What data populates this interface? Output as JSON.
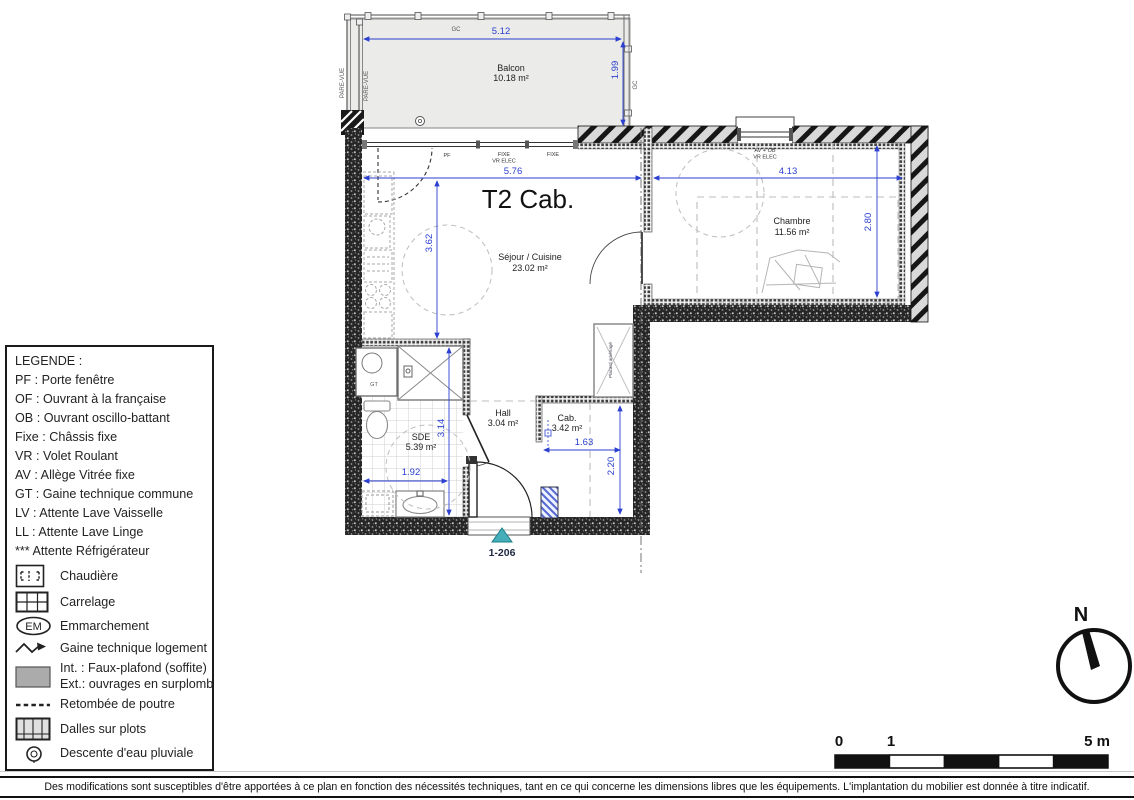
{
  "title": "T2 Cab.",
  "plan": {
    "balcony": {
      "name": "Balcon",
      "area": "10.18 m²",
      "width": "5.12",
      "depth": "1.99",
      "gc_top": "GC",
      "gc_right": "GC",
      "pare_vue_1": "PARE-VUE",
      "pare_vue_2": "PARE-VUE"
    },
    "sejour": {
      "name": "Séjour / Cuisine",
      "area": "23.02 m²",
      "width": "5.76",
      "height": "3.62"
    },
    "chambre": {
      "name": "Chambre",
      "area": "11.56 m²",
      "width": "4.13",
      "height": "2.80"
    },
    "sde": {
      "name": "SDE",
      "area": "5.39 m²",
      "width": "1.92",
      "height": "3.14"
    },
    "hall": {
      "name": "Hall",
      "area": "3.04 m²"
    },
    "cab": {
      "name": "Cab.",
      "area": "3.42 m²",
      "width": "1.63",
      "height": "2.20"
    },
    "placard": {
      "name": "Placard aménagé"
    },
    "gt_label": "GT",
    "entry_ref": "1-206",
    "window_labels": {
      "pf": "PF",
      "fixe": "FIXE",
      "vr_elec": "VR ELEC",
      "fixe2": "FIXE",
      "av_ob": "AV + OB",
      "vr_elec2": "VR ELEC"
    }
  },
  "legend": {
    "title": "LEGENDE :",
    "lines": [
      "PF : Porte fenêtre",
      "OF : Ouvrant à la française",
      "OB : Ouvrant oscillo-battant",
      "Fixe : Châssis fixe",
      "VR : Volet Roulant",
      "AV : Allège Vitrée fixe",
      "GT : Gaine technique commune",
      "LV : Attente Lave Vaisselle",
      "LL : Attente Lave Linge",
      "*** Attente Réfrigérateur"
    ],
    "icon_items": [
      {
        "icon": "boiler-icon",
        "text": "Chaudière"
      },
      {
        "icon": "tiles-icon",
        "text": "Carrelage"
      },
      {
        "icon": "em-icon",
        "em": "EM",
        "text": "Emmarchement"
      },
      {
        "icon": "duct-arrow-icon",
        "text": "Gaine technique logement"
      },
      {
        "icon": "soffit-icon",
        "text": "Int. : Faux-plafond (soffite)",
        "text2": "Ext.: ouvrages en surplomb"
      },
      {
        "icon": "beam-icon",
        "text": "Retombée de poutre"
      },
      {
        "icon": "slab-icon",
        "text": "Dalles sur plots"
      },
      {
        "icon": "downpipe-icon",
        "text": "Descente d'eau pluviale"
      }
    ]
  },
  "compass": {
    "north": "N"
  },
  "scale_bar": {
    "zero": "0",
    "one": "1",
    "five": "5 m"
  },
  "footer": {
    "disclaimer": "Des modifications sont susceptibles d'être apportées à ce plan en fonction des nécessités techniques, tant en ce qui concerne les dimensions libres que les équipements. L'implantation du mobilier est donnée à titre indicatif."
  },
  "colors": {
    "dimension": "#2b3fd0",
    "entry_marker": "#46aeb9"
  }
}
